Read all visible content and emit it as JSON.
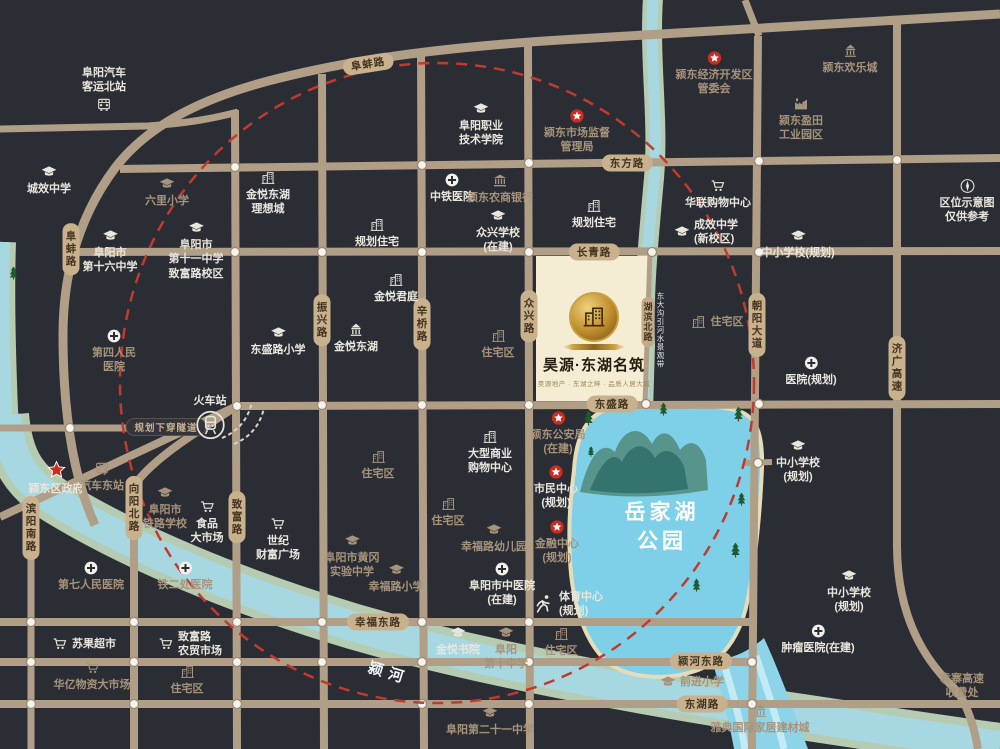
{
  "project": {
    "name": "昊源·东湖名筑",
    "tagline": "昊源地产 · 东湖之畔 · 品质人居大城",
    "x": 594,
    "y": 292
  },
  "colors": {
    "background": "#2b2d34",
    "road": "#b19e87",
    "pill": "#c9b18d",
    "red_circle": "#c03a2e",
    "star_red": "#ce2a1f",
    "lake": "#7ed0e9",
    "river": "#a7d8e2",
    "bank": "#b5cbb2",
    "label_white": "#e9e6dd",
    "label_tan": "#a6937b",
    "project_block": "#f4edd4"
  },
  "map": {
    "road_labels": [
      {
        "id": "road-label-dongfang",
        "text": "东方路",
        "x": 627,
        "y": 163,
        "dir": "h"
      },
      {
        "id": "road-label-changqing",
        "text": "长青路",
        "x": 594,
        "y": 252,
        "dir": "h"
      },
      {
        "id": "road-label-dongsheng",
        "text": "东盛路",
        "x": 612,
        "y": 404,
        "dir": "h"
      },
      {
        "id": "road-label-xingfu-east",
        "text": "幸福东路",
        "x": 378,
        "y": 622,
        "dir": "h"
      },
      {
        "id": "road-label-yinghe-east",
        "text": "颍河东路",
        "x": 701,
        "y": 661,
        "dir": "h"
      },
      {
        "id": "road-label-donghu",
        "text": "东湖路",
        "x": 702,
        "y": 704,
        "dir": "h"
      },
      {
        "id": "road-label-fubeng-west",
        "text": "阜蚌路",
        "x": 71,
        "y": 249,
        "dir": "v"
      },
      {
        "id": "road-label-fubeng-north",
        "text": "阜蚌路",
        "x": 368,
        "y": 64,
        "dir": "rot"
      },
      {
        "id": "road-label-binyang-south",
        "text": "滨阳南路",
        "x": 31,
        "y": 528,
        "dir": "v"
      },
      {
        "id": "road-label-xiangyang-north",
        "text": "向阳北路",
        "x": 134,
        "y": 508,
        "dir": "v"
      },
      {
        "id": "road-label-zhifu",
        "text": "致富路",
        "x": 237,
        "y": 517,
        "dir": "v"
      },
      {
        "id": "road-label-zhenxing",
        "text": "振兴路",
        "x": 322,
        "y": 320,
        "dir": "v"
      },
      {
        "id": "road-label-xinqiao",
        "text": "辛桥路",
        "x": 422,
        "y": 324,
        "dir": "v"
      },
      {
        "id": "road-label-zhongxing",
        "text": "众兴路",
        "x": 529,
        "y": 316,
        "dir": "v"
      },
      {
        "id": "road-label-hubin-north",
        "text": "湖滨北路",
        "x": 648,
        "y": 322,
        "dir": "v",
        "small": true
      },
      {
        "id": "road-label-chaoyang-avenue",
        "text": "朝阳大道",
        "x": 757,
        "y": 325,
        "dir": "v"
      },
      {
        "id": "road-label-jiguang-expressway",
        "text": "济广高速",
        "x": 897,
        "y": 368,
        "dir": "v"
      },
      {
        "id": "road-label-tunnel-plan",
        "text": "规划下穿隧道",
        "x": 166,
        "y": 427,
        "dir": "dark"
      }
    ],
    "water_labels": [
      {
        "id": "yuejiahu-park-name",
        "lines": [
          "岳家湖",
          "公园"
        ],
        "x": 662,
        "y": 498,
        "kind": "lake"
      },
      {
        "id": "yinghe-river-name",
        "lines": [
          "颍河"
        ],
        "x": 368,
        "y": 662,
        "kind": "river",
        "rotate": 17
      },
      {
        "id": "donggou-waterway-name",
        "lines": [
          "东大沟引河水景观带"
        ],
        "x": 655,
        "y": 292,
        "kind": "waterway"
      }
    ],
    "landmarks": [
      {
        "id": "bus-station-north",
        "icon": "bus",
        "iconpos": "bottom",
        "x": 104,
        "y": 66,
        "lines": [
          "阜阳汽车",
          "客运北站"
        ]
      },
      {
        "id": "chengxiao-middle-school",
        "icon": "cap",
        "x": 49,
        "y": 164,
        "lines": [
          "城效中学"
        ]
      },
      {
        "id": "liuli-primary-school",
        "icon": "cap",
        "x": 167,
        "y": 176,
        "lines": [
          "六里小学"
        ],
        "tone": "tan"
      },
      {
        "id": "jinyue-donghu-lixiangcheng",
        "icon": "bldg",
        "x": 268,
        "y": 170,
        "lines": [
          "金悦东湖",
          "理想城"
        ]
      },
      {
        "id": "fuyang-no16-middle-school",
        "icon": "cap",
        "x": 110,
        "y": 228,
        "lines": [
          "阜阳市",
          "第十六中学"
        ]
      },
      {
        "id": "fuyang-no11-middle-school",
        "icon": "cap",
        "x": 196,
        "y": 220,
        "lines": [
          "阜阳市",
          "第十一中学",
          "致富路校区"
        ]
      },
      {
        "id": "fuyang-vocational-college",
        "icon": "cap",
        "x": 481,
        "y": 101,
        "lines": [
          "阜阳职业",
          "技术学院"
        ]
      },
      {
        "id": "market-supervision-bureau",
        "icon": "starc",
        "x": 577,
        "y": 108,
        "lines": [
          "颍东市场监督",
          "管理局"
        ],
        "tone": "tan"
      },
      {
        "id": "zhongtie-hospital",
        "icon": "cross",
        "x": 452,
        "y": 172,
        "lines": [
          "中铁医院"
        ]
      },
      {
        "id": "nongshang-bank",
        "icon": "bank",
        "x": 500,
        "y": 173,
        "lines": [
          "颍东农商银行"
        ],
        "tone": "tan"
      },
      {
        "id": "planned-residential-west",
        "icon": "bldg",
        "x": 377,
        "y": 217,
        "lines": [
          "规划住宅"
        ]
      },
      {
        "id": "zhongxing-school",
        "icon": "cap",
        "x": 498,
        "y": 208,
        "lines": [
          "众兴学校",
          "(在建)"
        ]
      },
      {
        "id": "planned-residential-east",
        "icon": "bldg",
        "x": 594,
        "y": 198,
        "lines": [
          "规划住宅"
        ]
      },
      {
        "id": "chengxiao-new-campus",
        "icon": "cap",
        "iconpos": "left",
        "x": 706,
        "y": 218,
        "lines": [
          "成效中学",
          "(新校区)"
        ]
      },
      {
        "id": "hualian-shopping-center",
        "icon": "cart",
        "x": 718,
        "y": 178,
        "lines": [
          "华联购物中心"
        ]
      },
      {
        "id": "economic-development-zone",
        "icon": "starc",
        "x": 714,
        "y": 50,
        "lines": [
          "颍东经济开发区",
          "管委会"
        ],
        "tone": "tan"
      },
      {
        "id": "yingdong-huanlecheng",
        "icon": "pavilion",
        "x": 850,
        "y": 43,
        "lines": [
          "颍东欢乐城"
        ],
        "tone": "tan"
      },
      {
        "id": "yingtian-industrial-park",
        "icon": "factory",
        "x": 801,
        "y": 96,
        "lines": [
          "颍东盈田",
          "工业园区"
        ],
        "tone": "tan"
      },
      {
        "id": "location-map-disclaimer",
        "icon": "compass",
        "x": 967,
        "y": 178,
        "lines": [
          "区位示意图",
          "仅供参考"
        ]
      },
      {
        "id": "school-planned-north",
        "icon": "cap",
        "x": 798,
        "y": 228,
        "lines": [
          "中小学校(规划)"
        ]
      },
      {
        "id": "dongshenglu-primary-school",
        "icon": "cap",
        "x": 278,
        "y": 325,
        "lines": [
          "东盛路小学"
        ]
      },
      {
        "id": "no4-people-hospital",
        "icon": "cross",
        "x": 114,
        "y": 328,
        "lines": [
          "第四人民",
          "医院"
        ],
        "tone": "tan"
      },
      {
        "id": "jinyue-junting",
        "icon": "bldg",
        "x": 396,
        "y": 272,
        "lines": [
          "金悦君庭"
        ]
      },
      {
        "id": "jinyue-donghu",
        "icon": "pavilion",
        "x": 356,
        "y": 322,
        "lines": [
          "金悦东湖"
        ]
      },
      {
        "id": "residential-mid",
        "icon": "bldg",
        "x": 498,
        "y": 328,
        "lines": [
          "住宅区"
        ],
        "tone": "tan"
      },
      {
        "id": "hospital-planned",
        "icon": "cross",
        "x": 811,
        "y": 355,
        "lines": [
          "医院(规划)"
        ]
      },
      {
        "id": "residential-east",
        "icon": "bldg",
        "iconpos": "left",
        "x": 717,
        "y": 314,
        "lines": [
          "住宅区"
        ],
        "tone": "tan"
      },
      {
        "id": "school-planned-east",
        "icon": "cap",
        "x": 798,
        "y": 438,
        "lines": [
          "中小学校",
          "(规划)"
        ]
      },
      {
        "id": "train-station",
        "icon": "train",
        "iconpos": "bottom",
        "x": 210,
        "y": 394,
        "lines": [
          "火车站"
        ],
        "sz": 30
      },
      {
        "id": "yingdong-district-government",
        "icon": "bigstar",
        "x": 56,
        "y": 460,
        "lines": [
          "颍东区政府"
        ],
        "sz": 20
      },
      {
        "id": "bus-station-east",
        "icon": "bus",
        "x": 102,
        "y": 461,
        "lines": [
          "汽车东站"
        ],
        "tone": "tan"
      },
      {
        "id": "railway-school",
        "icon": "cap",
        "x": 165,
        "y": 485,
        "lines": [
          "阜阳市",
          "铁路学校"
        ],
        "tone": "tan"
      },
      {
        "id": "food-market",
        "icon": "cart",
        "x": 207,
        "y": 499,
        "lines": [
          "食品",
          "大市场"
        ]
      },
      {
        "id": "century-wealth-plaza",
        "icon": "cart",
        "x": 278,
        "y": 516,
        "lines": [
          "世纪",
          "财富广场"
        ]
      },
      {
        "id": "large-shopping-center",
        "icon": "bldg",
        "x": 490,
        "y": 429,
        "lines": [
          "大型商业",
          "购物中心"
        ]
      },
      {
        "id": "residential-southwest",
        "icon": "bldg",
        "x": 378,
        "y": 449,
        "lines": [
          "住宅区"
        ],
        "tone": "tan"
      },
      {
        "id": "public-security-bureau",
        "icon": "starc",
        "x": 558,
        "y": 410,
        "lines": [
          "颍东公安局",
          "(在建)"
        ],
        "tone": "tan"
      },
      {
        "id": "civic-center",
        "icon": "starc",
        "x": 556,
        "y": 464,
        "lines": [
          "市民中心",
          "(规划)"
        ]
      },
      {
        "id": "finance-center",
        "icon": "starc",
        "x": 557,
        "y": 519,
        "lines": [
          "金融中心",
          "(规划)"
        ],
        "tone": "tan"
      },
      {
        "id": "sports-center",
        "icon": "runner",
        "iconpos": "left",
        "x": 568,
        "y": 590,
        "lines": [
          "体育中心",
          "(规划)"
        ],
        "sz": 22
      },
      {
        "id": "no7-people-hospital",
        "icon": "cross",
        "x": 91,
        "y": 560,
        "lines": [
          "第七人民医院"
        ],
        "tone": "tan"
      },
      {
        "id": "tieerchu-hospital",
        "icon": "cross",
        "x": 185,
        "y": 560,
        "lines": [
          "铁二处医院"
        ],
        "tone": "tan"
      },
      {
        "id": "suguo-supermarket",
        "icon": "cart",
        "iconpos": "left",
        "x": 84,
        "y": 636,
        "lines": [
          "苏果超市"
        ]
      },
      {
        "id": "zhifulu-farmers-market",
        "icon": "cart",
        "iconpos": "left",
        "x": 190,
        "y": 630,
        "lines": [
          "致富路",
          "农贸市场"
        ]
      },
      {
        "id": "huayi-materials-market",
        "icon": "cart",
        "x": 92,
        "y": 660,
        "lines": [
          "华亿物资大市场"
        ],
        "tone": "tan"
      },
      {
        "id": "residential-south",
        "icon": "bldg",
        "x": 187,
        "y": 664,
        "lines": [
          "住宅区"
        ],
        "tone": "tan"
      },
      {
        "id": "residential-center",
        "icon": "bldg",
        "x": 448,
        "y": 496,
        "lines": [
          "住宅区"
        ],
        "tone": "tan"
      },
      {
        "id": "xingfulu-kindergarten",
        "icon": "cap",
        "x": 494,
        "y": 522,
        "lines": [
          "幸福路幼儿园"
        ],
        "tone": "tan"
      },
      {
        "id": "huanggang-experimental-school",
        "icon": "cap",
        "x": 352,
        "y": 533,
        "lines": [
          "阜阳市黄冈",
          "实验中学"
        ],
        "tone": "tan"
      },
      {
        "id": "xingfulu-primary-school",
        "icon": "cap",
        "x": 396,
        "y": 562,
        "lines": [
          "幸福路小学"
        ],
        "tone": "tan"
      },
      {
        "id": "tcm-hospital",
        "icon": "cross",
        "x": 502,
        "y": 561,
        "lines": [
          "阜阳市中医院",
          "(在建)"
        ]
      },
      {
        "id": "jinyue-academy",
        "icon": "cap",
        "x": 458,
        "y": 625,
        "lines": [
          "金悦书院"
        ]
      },
      {
        "id": "fuyang-no10-middle-school",
        "icon": "cap",
        "x": 506,
        "y": 625,
        "lines": [
          "阜阳",
          "第十中学"
        ],
        "tone": "tan"
      },
      {
        "id": "residential-southeast",
        "icon": "bldg",
        "x": 561,
        "y": 626,
        "lines": [
          "住宅区"
        ],
        "tone": "tan"
      },
      {
        "id": "fuyang-no21-middle-school",
        "icon": "cap",
        "x": 490,
        "y": 705,
        "lines": [
          "阜阳第二十一中学"
        ],
        "tone": "tan"
      },
      {
        "id": "yadian-home-furnishing-city",
        "icon": "pavilion",
        "x": 760,
        "y": 703,
        "lines": [
          "雅典国际家居建材城"
        ],
        "tone": "tan"
      },
      {
        "id": "qianjin-primary-school",
        "icon": "cap",
        "iconpos": "left",
        "x": 692,
        "y": 674,
        "lines": [
          "前进小学"
        ],
        "tone": "tan"
      },
      {
        "id": "school-planned-southeast",
        "icon": "cap",
        "x": 849,
        "y": 568,
        "lines": [
          "中小学校",
          "(规划)"
        ]
      },
      {
        "id": "tumor-hospital",
        "icon": "cross",
        "x": 818,
        "y": 623,
        "lines": [
          "肿瘤医院(在建)"
        ]
      },
      {
        "id": "yuanzhai-toll-station",
        "icon": null,
        "x": 962,
        "y": 672,
        "lines": [
          "袁寨高速",
          "收费处"
        ],
        "tone": "tan"
      }
    ]
  }
}
